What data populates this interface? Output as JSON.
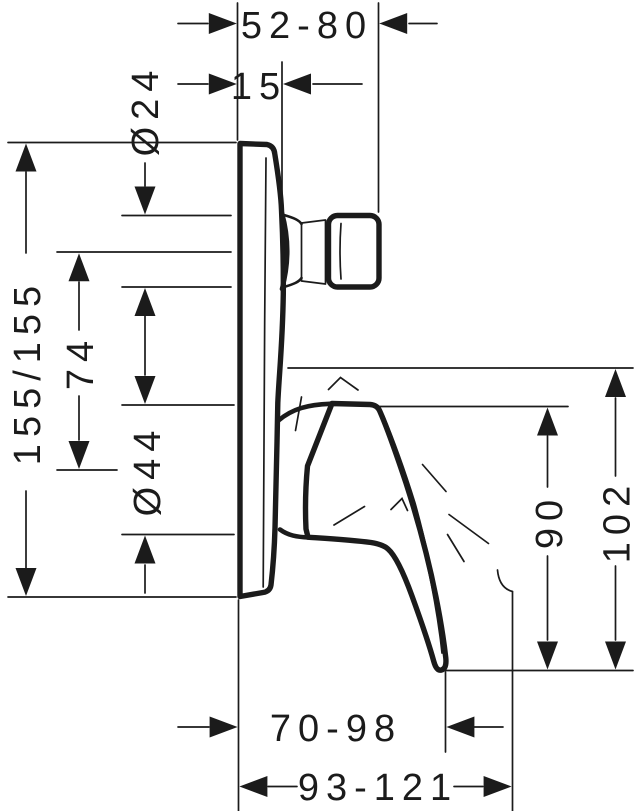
{
  "drawing": {
    "kind": "technical-dimension-drawing",
    "line_color": "#1b1b1b",
    "background_color": "#ffffff",
    "dimensions": {
      "depth_range_top": "52-80",
      "stem_offset": "15",
      "stem_diameter": "Ø24",
      "plate_size": "155/155",
      "axis_spacing": "74",
      "sleeve_diameter": "Ø44",
      "lever_height": "90",
      "total_height": "102",
      "lever_depth_range": "70-98",
      "total_depth_range": "93-121"
    }
  }
}
